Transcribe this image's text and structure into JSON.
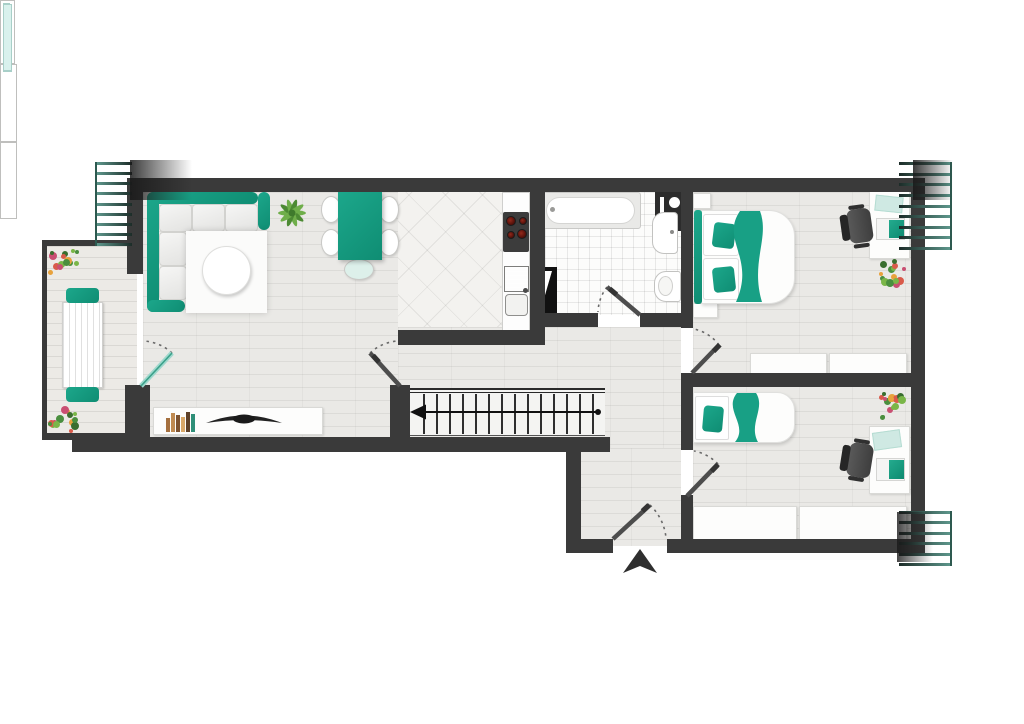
{
  "plan": {
    "kind": "apartment-floor-plan",
    "visible_text": [],
    "colors": {
      "wall": "#3a3a3a",
      "wall_dark": "#2c2c2c",
      "teal": "#1ca78b",
      "teal_d": "#0f8d73",
      "glass": "#d9f1ed",
      "furn": "#fdfdfc",
      "furnb": "#d9d9d6",
      "wood": "#eae9e6",
      "deck": "#eceae6",
      "ktile": "#f3f2ef",
      "btile": "#fcfcfb"
    },
    "rooms": [
      {
        "id": "balcony",
        "furniture": [
          "outdoor-table",
          "outdoor-chair",
          "outdoor-chair",
          "flower-pot",
          "flower-pot"
        ]
      },
      {
        "id": "living-dining-room",
        "furniture": [
          "corner-sofa",
          "rug",
          "coffee-table",
          "plant",
          "dining-table",
          "dining-chairs-x5",
          "sideboard",
          "books",
          "tv"
        ]
      },
      {
        "id": "kitchen",
        "furniture": [
          "counter",
          "cooktop",
          "sink"
        ]
      },
      {
        "id": "bathroom",
        "furniture": [
          "bathtub",
          "washbasin",
          "toilet",
          "service-shaft",
          "appliance"
        ]
      },
      {
        "id": "bedroom-1",
        "furniture": [
          "double-bed",
          "pillows-x2",
          "nightstand",
          "nightstand",
          "wardrobe-x2",
          "desk",
          "laptop",
          "paper",
          "office-chair",
          "flowers",
          "window"
        ]
      },
      {
        "id": "bedroom-2",
        "furniture": [
          "single-bed",
          "pillow",
          "wardrobe-x2",
          "desk",
          "laptop",
          "paper",
          "office-chair",
          "flowers",
          "window"
        ]
      },
      {
        "id": "hallway",
        "furniture": [
          "staircase"
        ]
      },
      {
        "id": "entrance-hall",
        "furniture": [
          "entrance-door",
          "entrance-arrow"
        ]
      }
    ],
    "stairs": {
      "tread_lines": 14,
      "arrow_direction": "left"
    },
    "doors": [
      "balcony-glass-door",
      "living-room-door",
      "bathroom-door",
      "bedroom-1-door",
      "bedroom-2-door",
      "entrance-door"
    ],
    "windows": [
      "balcony-fixed-pane",
      "bedroom-1-window",
      "bedroom-2-window"
    ],
    "shutters": {
      "top_left_lines": 9,
      "top_right_lines": 9,
      "bottom_right_lines": 6
    },
    "books_colors": [
      "#a5703f",
      "#c08b52",
      "#7e5330",
      "#d9a868",
      "#5f4128",
      "#2f8f78"
    ],
    "flower_palette": [
      "#4a8f3f",
      "#7ab648",
      "#d95a4a",
      "#e8a23c",
      "#c94f72",
      "#3a6e2f"
    ],
    "cooktop_burners": 4
  }
}
